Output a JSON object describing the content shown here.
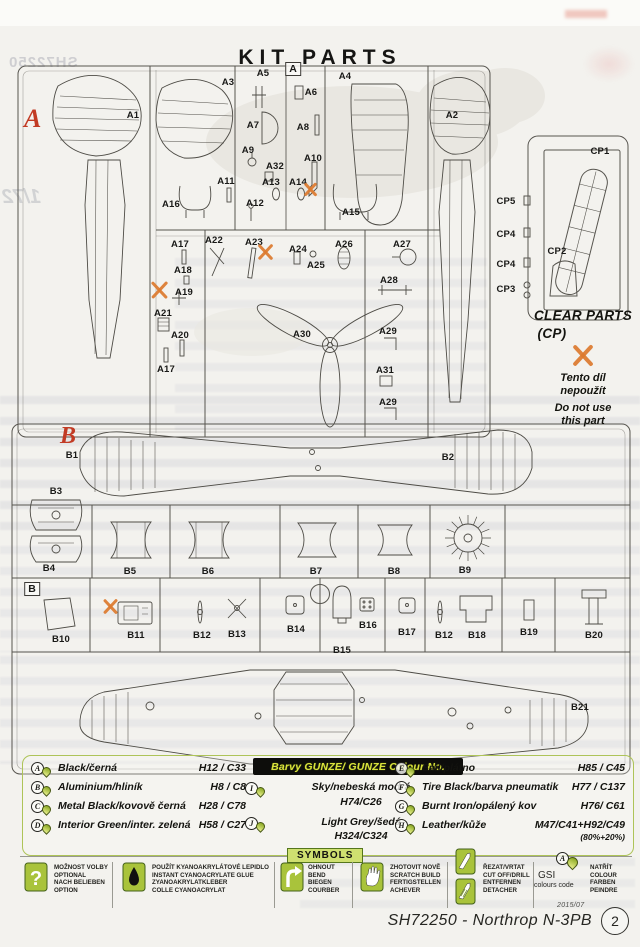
{
  "page": {
    "title": "KIT PARTS",
    "footer": {
      "date": "2015/07",
      "product": "SH72250 - Northrop N-3PB",
      "page_number": "2"
    },
    "bleedthrough": {
      "kit_number": "SH72250",
      "scale": "1/72"
    }
  },
  "sprue_a": {
    "letter": "A",
    "frame_letter": "A",
    "part_labels": {
      "A1": "A1",
      "A2": "A2",
      "A3": "A3",
      "A4": "A4",
      "A5": "A5",
      "A6": "A6",
      "A7": "A7",
      "A8": "A8",
      "A9": "A9",
      "A10": "A10",
      "A11": "A11",
      "A12": "A12",
      "A13": "A13",
      "A14": "A14",
      "A15": "A15",
      "A16": "A16",
      "A17": "A17",
      "A17b": "A17",
      "A18": "A18",
      "A19": "A19",
      "A20": "A20",
      "A21": "A21",
      "A22": "A22",
      "A23": "A23",
      "A24": "A24",
      "A25": "A25",
      "A26": "A26",
      "A27": "A27",
      "A28": "A28",
      "A29": "A29",
      "A29b": "A29",
      "A30": "A30",
      "A31": "A31",
      "A32": "A32"
    }
  },
  "sprue_b": {
    "letter": "B",
    "frame_letter": "B",
    "part_labels": {
      "B1": "B1",
      "B2": "B2",
      "B3": "B3",
      "B4": "B4",
      "B5": "B5",
      "B6": "B6",
      "B7": "B7",
      "B8": "B8",
      "B9": "B9",
      "B10": "B10",
      "B11": "B11",
      "B12": "B12",
      "B12b": "B12",
      "B13": "B13",
      "B14": "B14",
      "B15": "B15",
      "B16": "B16",
      "B17": "B17",
      "B18": "B18",
      "B19": "B19",
      "B20": "B20",
      "B21": "B21"
    }
  },
  "clear_parts": {
    "part_labels": {
      "CP1": "CP1",
      "CP2": "CP2",
      "CP3": "CP3",
      "CP4a": "CP4",
      "CP4b": "CP4",
      "CP5": "CP5"
    },
    "heading_line1": "CLEAR PARTS",
    "heading_line2": "(CP)",
    "note_cz_line1": "Tento díl",
    "note_cz_line2": "nepoužít",
    "note_en_line1": "Do not use",
    "note_en_line2": "this part"
  },
  "colour_table": {
    "header": "Barvy GUNZE/ GUNZE Colour No.",
    "left": [
      {
        "letter": "A",
        "name": "Black/černá",
        "code": "H12 / C33"
      },
      {
        "letter": "B",
        "name": "Aluminium/hliník",
        "code": "H8 / C8"
      },
      {
        "letter": "C",
        "name": "Metal Black/kovově černá",
        "code": "H28 / C78"
      },
      {
        "letter": "D",
        "name": "Interior Green/inter. zelená",
        "code": "H58 / C27"
      }
    ],
    "middle": [
      {
        "letter": "I",
        "name": "Sky/nebeská modrá",
        "code": "H74/C26"
      },
      {
        "letter": "J",
        "name": "Light Grey/šedá",
        "code": "H324/C324"
      }
    ],
    "right": [
      {
        "letter": "E",
        "name": "Sail/plátno",
        "code": "H85 / C45"
      },
      {
        "letter": "F",
        "name": "Tire Black/barva pneumatik",
        "code": "H77 / C137"
      },
      {
        "letter": "G",
        "name": "Burnt Iron/opálený kov",
        "code": "H76/ C61"
      },
      {
        "letter": "H",
        "name": "Leather/kůže",
        "code": "M47/C41+H92/C49",
        "code2": "(80%+20%)"
      }
    ]
  },
  "symbols": {
    "heading": "SYMBOLS",
    "question_glyph": "?",
    "gsi": {
      "label": "GSI",
      "sub": "colours code",
      "letter": "A"
    },
    "items": [
      {
        "icon": "question",
        "lines": [
          "MOŽNOST VOLBY",
          "OPTIONAL",
          "NACH BELIEBEN",
          "OPTION"
        ]
      },
      {
        "icon": "glue-drop",
        "lines": [
          "POUŽÍT KYANOAKRYLÁTOVÉ LEPIDLO",
          "INSTANT CYANOACRYLATE GLUE",
          "ZYANOAKRYLATKLEBER",
          "COLLE CYANOACRYLAT"
        ]
      },
      {
        "icon": "bend-arrow",
        "lines": [
          "OHNOUT",
          "BEND",
          "BIEGEN",
          "COURBER"
        ]
      },
      {
        "icon": "hand",
        "lines": [
          "ZHOTOVIT NOVĚ",
          "SCRATCH BUILD",
          "FERTIGSTELLEN",
          "ACHEVER"
        ]
      },
      {
        "icon": "knife",
        "lines": [
          "ŘEZAT/VRTAT",
          "CUT OFF/DRILL",
          "ENTFERNEN",
          "DETACHER"
        ]
      },
      {
        "icon": "gsi-drop",
        "lines": [
          "NATŘÍT",
          "COLOUR",
          "FARBEN",
          "PEINDRE"
        ]
      }
    ]
  },
  "colors": {
    "accent_green": "#a9c33b",
    "orange_x": "#dc7a2e",
    "red_letter": "#c23b24"
  }
}
